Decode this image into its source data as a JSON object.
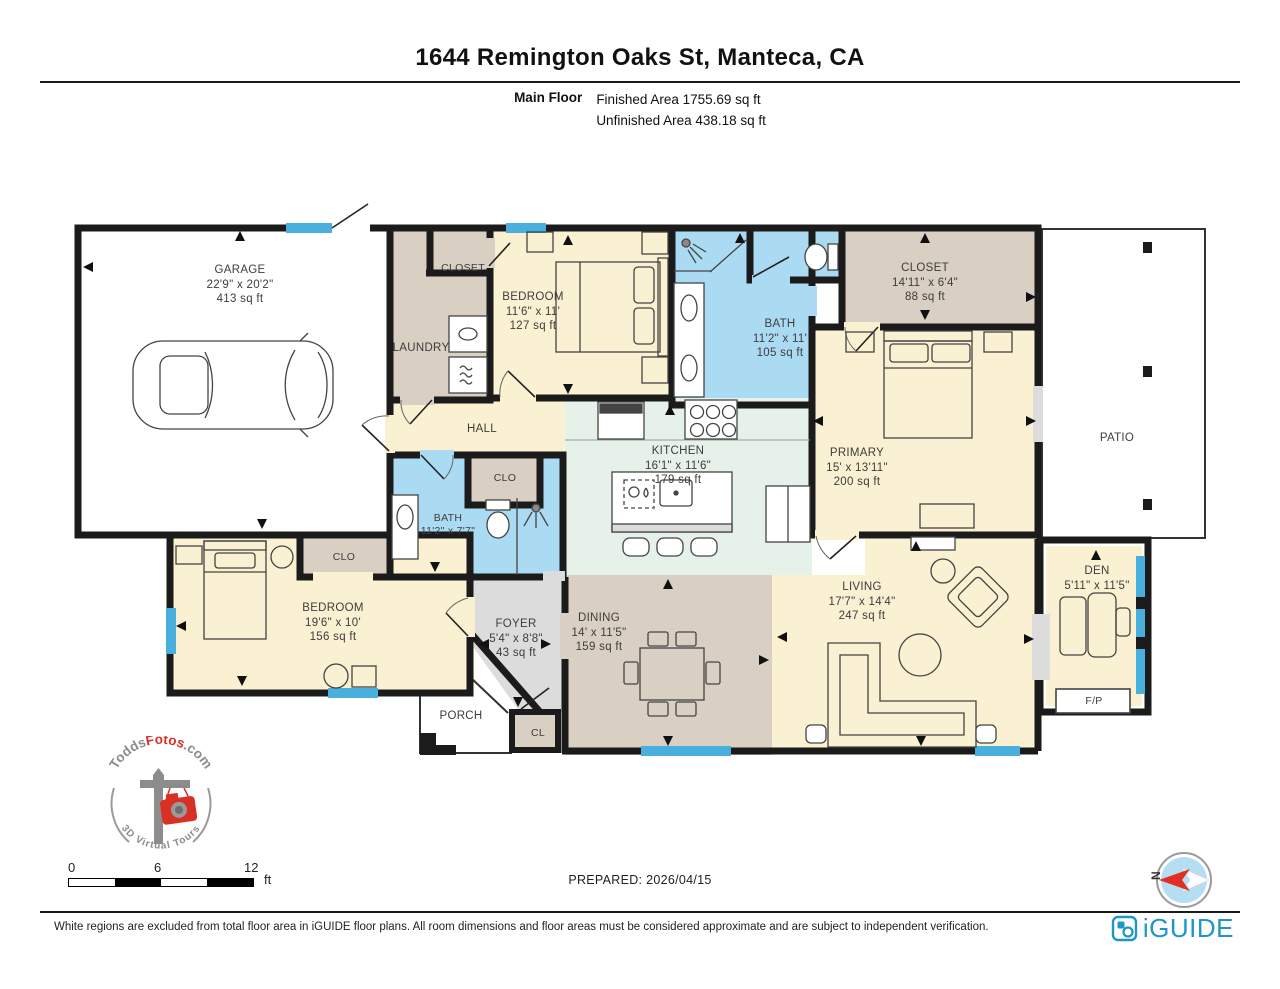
{
  "header": {
    "title": "1644 Remington Oaks St, Manteca, CA",
    "floor_label": "Main Floor",
    "finished": "Finished Area 1755.69 sq ft",
    "unfinished": "Unfinished Area 438.18 sq ft"
  },
  "rooms": {
    "garage": {
      "name": "GARAGE",
      "dims": "22'9\" x 20'2\"",
      "area": "413 sq ft"
    },
    "closet_top": {
      "name": "CLOSET"
    },
    "laundry": {
      "name": "LAUNDRY"
    },
    "bedroom_top": {
      "name": "BEDROOM",
      "dims": "11'6\" x 11'",
      "area": "127 sq ft"
    },
    "bath_top": {
      "name": "BATH",
      "dims": "11'2\" x 11'",
      "area": "105 sq ft"
    },
    "closet_primary": {
      "name": "CLOSET",
      "dims": "14'11\" x 6'4\"",
      "area": "88 sq ft"
    },
    "primary": {
      "name": "PRIMARY",
      "dims": "15' x 13'11\"",
      "area": "200 sq ft"
    },
    "patio": {
      "name": "PATIO"
    },
    "hall": {
      "name": "HALL"
    },
    "kitchen": {
      "name": "KITCHEN",
      "dims": "16'1\" x 11'6\"",
      "area": "179 sq ft"
    },
    "clo_mid": {
      "name": "CLO"
    },
    "bath_mid": {
      "name": "BATH",
      "dims": "11'2\" x 7'7\""
    },
    "clo_left": {
      "name": "CLO"
    },
    "bedroom_left": {
      "name": "BEDROOM",
      "dims": "19'6\" x 10'",
      "area": "156 sq ft"
    },
    "foyer": {
      "name": "FOYER",
      "dims": "5'4\" x 8'8\"",
      "area": "43 sq ft"
    },
    "porch": {
      "name": "PORCH"
    },
    "cl": {
      "name": "CL"
    },
    "dining": {
      "name": "DINING",
      "dims": "14' x 11'5\"",
      "area": "159 sq ft"
    },
    "living": {
      "name": "LIVING",
      "dims": "17'7\" x 14'4\"",
      "area": "247 sq ft"
    },
    "den": {
      "name": "DEN",
      "dims": "5'11\" x 11'5\""
    },
    "fireplace": {
      "name": "F/P"
    }
  },
  "scale_bar": {
    "start": "0",
    "mid": "6",
    "end": "12",
    "unit": "ft"
  },
  "prepared": "PREPARED: 2026/04/15",
  "compass": {
    "label": "N"
  },
  "logo": {
    "todds": "Todds",
    "fotos": "Fotos",
    "com": ".com",
    "tagline": "3D Virtual Tours"
  },
  "footer": {
    "disclaimer": "White regions are excluded from total floor area in iGUIDE floor plans. All room dimensions and floor areas must be considered approximate and are subject to independent verification.",
    "brand": "iGUIDE"
  },
  "colors": {
    "wall": "#1B1B1B",
    "window_blue": "#49AFDC",
    "room_cream": "#FAF0D2",
    "room_tan": "#D9CFC2",
    "room_blue": "#ABDBF2",
    "room_mint": "#E6F1E9",
    "room_gray": "#DCDCDC",
    "accent_red": "#D93025",
    "brand_blue": "#2095C8"
  }
}
